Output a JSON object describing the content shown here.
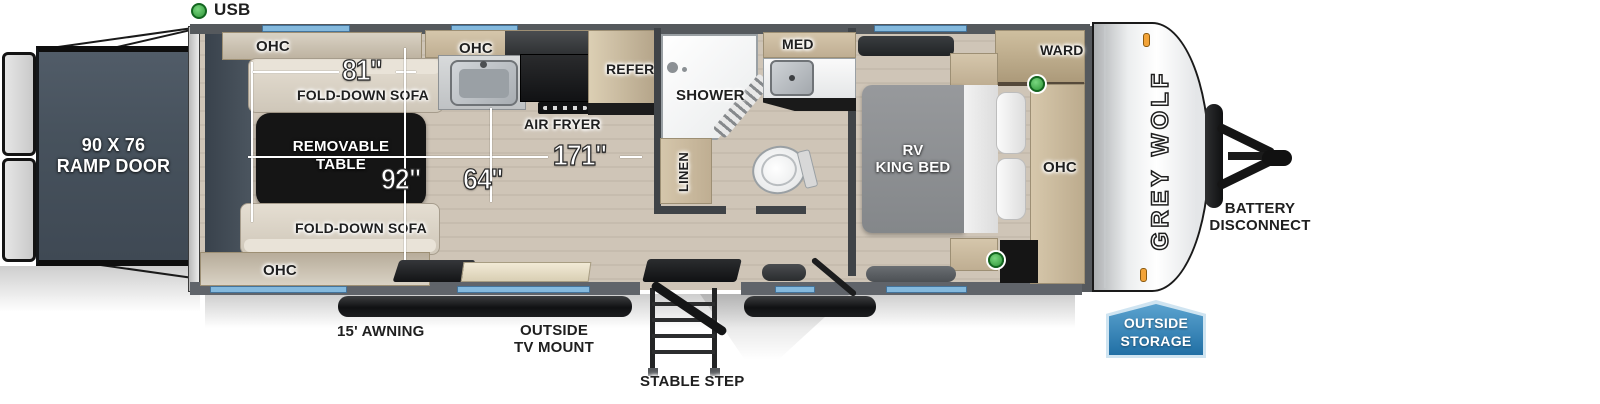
{
  "legend": {
    "usb": "USB"
  },
  "rear": {
    "ramp_line1": "90 X 76",
    "ramp_line2": "RAMP DOOR"
  },
  "living": {
    "ohc_top": "OHC",
    "sofa_top": "FOLD-DOWN SOFA",
    "table_line1": "REMOVABLE",
    "table_line2": "TABLE",
    "sofa_bottom": "FOLD-DOWN SOFA",
    "ohc_bottom": "OHC"
  },
  "dims": {
    "sofa_length": "81\"",
    "interior_width": "92\"",
    "cargo_length": "171\"",
    "aisle_width": "64\""
  },
  "kitchen": {
    "ohc": "OHC",
    "air_fryer": "AIR FRYER",
    "refer": "REFER"
  },
  "bath": {
    "shower": "SHOWER",
    "med": "MED",
    "linen": "LINEN"
  },
  "bedroom": {
    "bed_line1": "RV",
    "bed_line2": "KING BED",
    "ward": "WARD",
    "ohc": "OHC"
  },
  "exterior": {
    "awning": "15' AWNING",
    "tv_mount_line1": "OUTSIDE",
    "tv_mount_line2": "TV MOUNT",
    "stable_step": "STABLE STEP",
    "battery_line1": "BATTERY",
    "battery_line2": "DISCONNECT",
    "storage_line1": "OUTSIDE",
    "storage_line2": "STORAGE"
  },
  "brand": {
    "logo": "GREY WOLF"
  },
  "colors": {
    "usb_green": "#3fae49",
    "window_blue": "#84b9dd",
    "badge_blue": "#2b7ab2",
    "ramp_slate": "#49545f",
    "floor_wood": "#cdc3b5",
    "cabinet_wood": "#c4b499",
    "accent_black": "#17181a"
  }
}
